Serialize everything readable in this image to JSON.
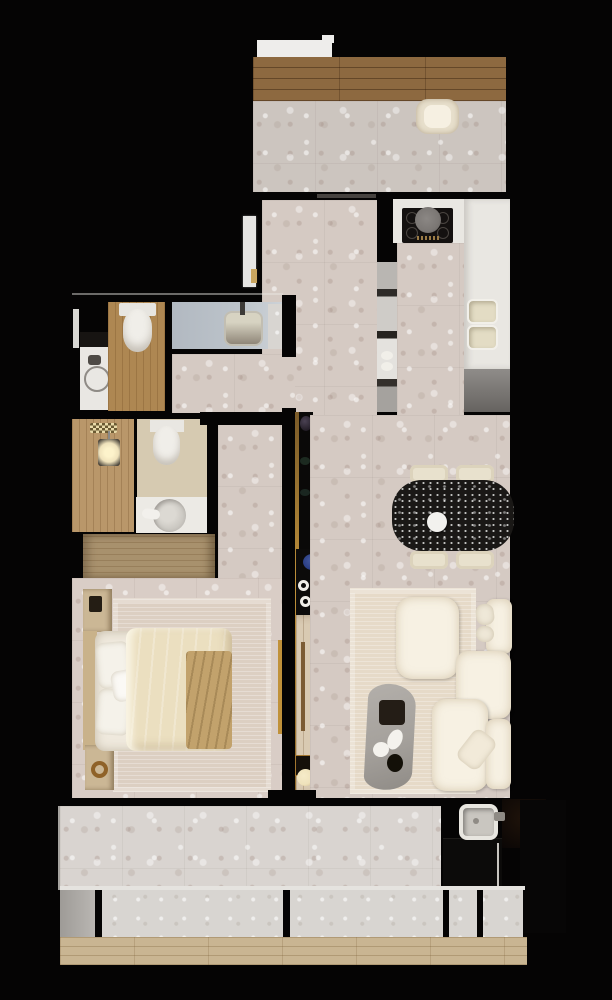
{
  "meta": {
    "title": "apartment-floor-plan-render",
    "view": "top-down 3d render",
    "canvas": {
      "width": 612,
      "height": 1000
    }
  },
  "palette": {
    "wall_black": "#050404",
    "terrazzo_main": "#d5cac3",
    "terrazzo_balcony_top": "#ccc5bf",
    "terrazzo_bedroom": "#d9cdc6",
    "terrazzo_balcony_bottom": "#d9d4d0",
    "ledge_stone": "#d8d5d1",
    "deck_dark_wood": "#8d6940",
    "deck_light_wood": "#c9b592",
    "bathroom_wood": "#ae8752",
    "shower_wood": "#b9976a",
    "wardrobe_wood": "#a8916d",
    "console_wood": "#d9cab2",
    "nightstand_wood": "#cbb795",
    "counter_white": "#e9e7e2",
    "counter_gray": "#8f8c89",
    "cooktop_black": "#141110",
    "pot_gray": "#7b7774",
    "sink_cream": "#e3dcc4",
    "vanity_blue": "#bcc3ca",
    "toilet_white": "#f0eee9",
    "bed_duvet": "#ebdfc0",
    "bed_pillow": "#f5f2ea",
    "bed_throw": "#c2a26c",
    "mattress_white": "#efe9dd",
    "rug_bedroom": "#dccfc2",
    "rug_living": "#e6dac8",
    "sofa_cream": "#f7f1e3",
    "coffee_table_gray": "#a5a19c",
    "dining_table_black": "#1a1816",
    "chair_cream": "#e8e1cd",
    "gold_trim": "#c0913a",
    "blue_glass": "#2b3f85",
    "lamp_glow": "#efe2bb",
    "door_white": "#e6e5e3",
    "ac_white": "#eeedeb"
  },
  "rooms": [
    {
      "id": "balcony-top",
      "label": "upper balcony",
      "features": [
        "wood deck",
        "terrazzo floor",
        "armchair",
        "ac-unit"
      ]
    },
    {
      "id": "entry-hall",
      "label": "entry hall",
      "features": [
        "front door",
        "terrazzo floor"
      ]
    },
    {
      "id": "kitchen",
      "label": "kitchen",
      "features": [
        "cooktop with pot",
        "double sink",
        "tall cabinet",
        "counters"
      ]
    },
    {
      "id": "bathroom-main",
      "label": "main bathroom",
      "features": [
        "toilet",
        "vanity sink",
        "towel ring",
        "wood floor"
      ]
    },
    {
      "id": "bathroom-shower",
      "label": "shower bathroom",
      "features": [
        "rain shower",
        "pendant light",
        "toilet",
        "round basin"
      ]
    },
    {
      "id": "wardrobe",
      "label": "wardrobe",
      "features": [
        "wood cabinet"
      ]
    },
    {
      "id": "bedroom",
      "label": "bedroom",
      "features": [
        "double bed",
        "rug",
        "nightstands",
        "headboard",
        "gold curtain"
      ]
    },
    {
      "id": "living-dining",
      "label": "living and dining",
      "features": [
        "dining table with 4 chairs",
        "modular sofa",
        "coffee table",
        "console shelf",
        "lamp"
      ]
    },
    {
      "id": "utility",
      "label": "utility corner",
      "features": [
        "laundry sink",
        "dark counters"
      ]
    },
    {
      "id": "balcony-bottom",
      "label": "lower terrace",
      "features": [
        "terrazzo floor",
        "stone ledge",
        "window mullions",
        "wood deck"
      ]
    }
  ],
  "furniture_counts": {
    "chairs_dining": 4,
    "sofa_cushions": 5,
    "sofa_pillows": 3,
    "toilets": 2,
    "sinks": 5,
    "beds": 1
  }
}
